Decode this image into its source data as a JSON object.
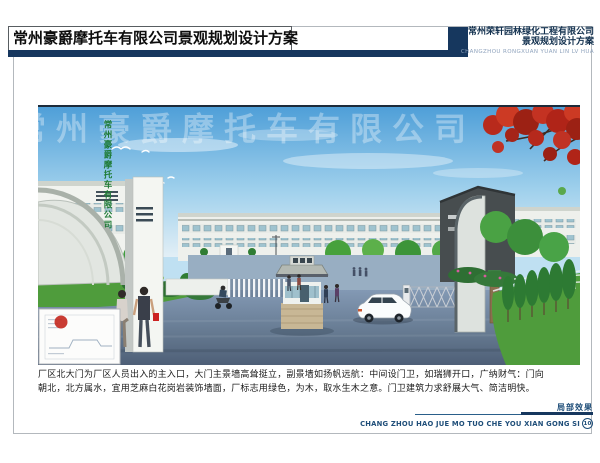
{
  "header": {
    "title": "常州豪爵摩托车有限公司景观规划设计方案",
    "accent_color": "#16375e",
    "right": {
      "company": "常州荣轩园林绿化工程有限公司",
      "subtitle": "景观规划设计方案",
      "pinyin": "CHANGZHOU RONGXUAN YUAN LIN LV HUA"
    }
  },
  "rendering": {
    "gate_pylon_text": "常州豪爵摩托车有限公司",
    "watermark_text": "常州豪爵摩托车有限公司",
    "pylon_text_color": "#1d7a33",
    "sky_color": "#4f9fd8",
    "road_color": "#74889f",
    "lawn_color": "#4f9c3c",
    "maple_color": "#b5291c"
  },
  "description": {
    "line1": "厂区北大门为厂区人员出入的主入口，大门主景墙高耸挺立，副景墙如扬帆远航：中间设门卫，如瑞狮开口，广纳财气：门向",
    "line2": "朝北，北方属水，宜用芝麻白花岗岩装饰墙面，厂标志用绿色，为木，取水生木之意。门卫建筑力求舒展大气、简洁明快。"
  },
  "footer": {
    "caption": "局部效果",
    "pinyin": "CHANG ZHOU HAO JUE MO TUO CHE YOU XIAN GONG SI",
    "page_number": "10"
  }
}
